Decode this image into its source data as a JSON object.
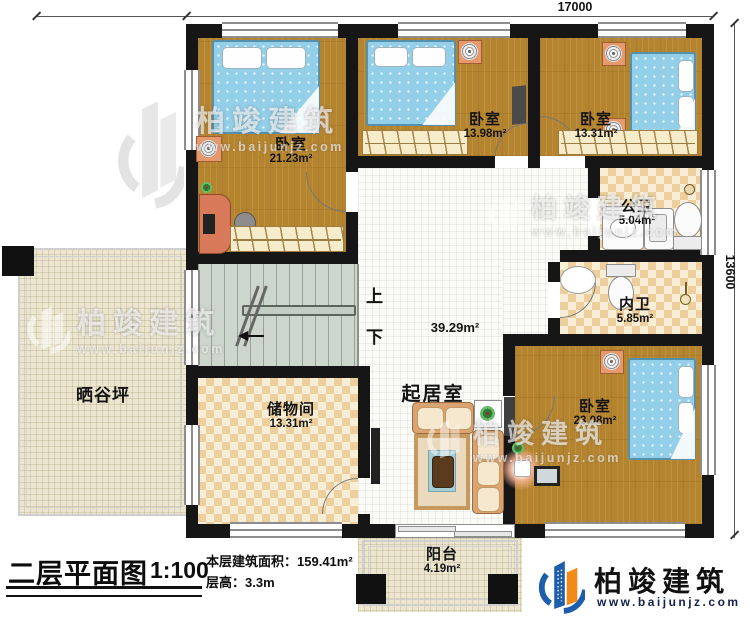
{
  "dimensions": {
    "top": "17000",
    "right": "13600"
  },
  "rooms": {
    "bedroom_top_left": {
      "name": "卧室",
      "area": "21.23m²"
    },
    "bedroom_top_middle": {
      "name": "卧室",
      "area": "13.98m²"
    },
    "bedroom_top_right": {
      "name": "卧室",
      "area": "13.31m²"
    },
    "public_bathroom": {
      "name": "公卫",
      "area": "5.04m²"
    },
    "inner_bathroom": {
      "name": "内卫",
      "area": "5.85m²"
    },
    "bedroom_bottom_right": {
      "name": "卧室",
      "area": "23.08m²"
    },
    "living_room": {
      "name": "起居室",
      "area": "39.29m²"
    },
    "storage_room": {
      "name": "储物间",
      "area": "13.31m²"
    },
    "drying_yard": {
      "name": "晒谷坪"
    },
    "balcony": {
      "name": "阳台",
      "area": "4.19m²"
    }
  },
  "stairs": {
    "up": "上",
    "down": "下"
  },
  "title_block": {
    "plan_name": "二层平面图",
    "scale": "1:100",
    "area_label": "本层建筑面积：",
    "area_value": "159.41m²",
    "floor_height_label": "层高：",
    "floor_height_value": "3.3m"
  },
  "brand": {
    "name": "柏竣建筑",
    "website": "www.baijunjz.com"
  },
  "watermark": {
    "name": "柏竣建筑",
    "website": "www.baijunjz.com"
  },
  "colors": {
    "wall": "#161616",
    "wood_floor": "#b5842f",
    "tile_floor": "#f0dcae",
    "bed_blue": "#93cfe8",
    "brand_blue": "#1d5dab",
    "brand_orange": "#f28a1a"
  }
}
